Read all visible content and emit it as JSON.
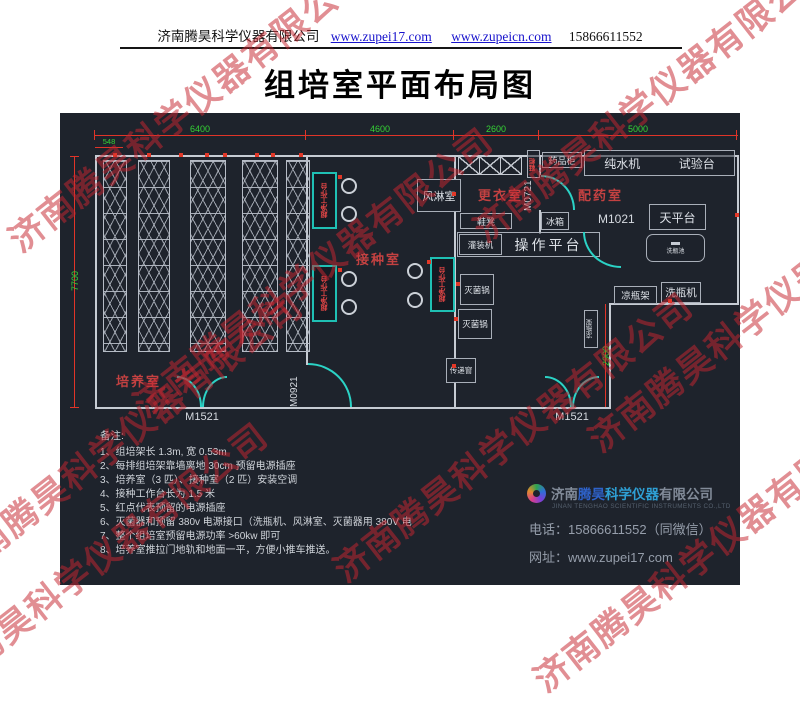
{
  "header": {
    "company": "济南腾昊科学仪器有限公司",
    "url1": "www.zupei17.com",
    "url2": "www.zupeicn.com",
    "phone": "15866611552"
  },
  "title": "组培室平面布局图",
  "watermark": {
    "text": "济南腾昊科学仪器有限公司"
  },
  "plan": {
    "dims": {
      "d548": "548",
      "d6400": "6400",
      "d4600": "4600",
      "d2600": "2600",
      "d5000": "5000",
      "d7700": "7700",
      "d2900": "2900"
    },
    "rooms": {
      "culture": "培养室",
      "inoculation": "接种室",
      "changing": "更衣室",
      "dispensing": "配药室"
    },
    "doors": {
      "m1521": "M1521",
      "m0921": "M0921",
      "m0721": "M0721",
      "m1021": "M1021"
    },
    "equip": {
      "air_shower": "风淋室",
      "shoe_cabinet": "鞋柜",
      "medicine_cabinet": "药品柜",
      "water_purifier": "纯水机",
      "test_bench": "试验台",
      "fridge": "冰箱",
      "balance_table": "天平台",
      "bottle_sink": "洗瓶池",
      "shoe_bench": "鞋凳",
      "filling_machine": "灌装机",
      "operation_platform": "操作平台",
      "sterilizer": "灭菌锅",
      "transfer_window": "传递窗",
      "bottle_rack": "凉瓶架",
      "bottle_washer": "洗瓶机",
      "clean_bench": "超净工作台"
    }
  },
  "notes": {
    "heading": "备注:",
    "items": [
      "1、组培架长 1.3m, 宽 0.53m",
      "2、每排组培架靠墙离地 30cm 预留电源插座",
      "3、培养室（3 匹）、接种室（2 匹）安装空调",
      "4、接种工作台长为 1.5 米",
      "5、红点代表预留的电源插座",
      "6、灭菌器和预留 380v 电源接口（洗瓶机、风淋室、灭菌器用 380V 电",
      "7、整个组培室预留电源功率 >60kw 即可",
      "8、培养室推拉门地轨和地面一平，方便小推车推送。"
    ]
  },
  "footer": {
    "brand_prefix": "济南",
    "brand_name": "腾昊",
    "brand_mid": "科学仪器",
    "brand_suffix": "有限公司",
    "brand_en": "JINAN TENGHAO SCIENTIFIC INSTRUMENTS CO.,LTD",
    "tel": "电话：15866611552（同微信）",
    "web": "网址：www.zupei17.com"
  }
}
